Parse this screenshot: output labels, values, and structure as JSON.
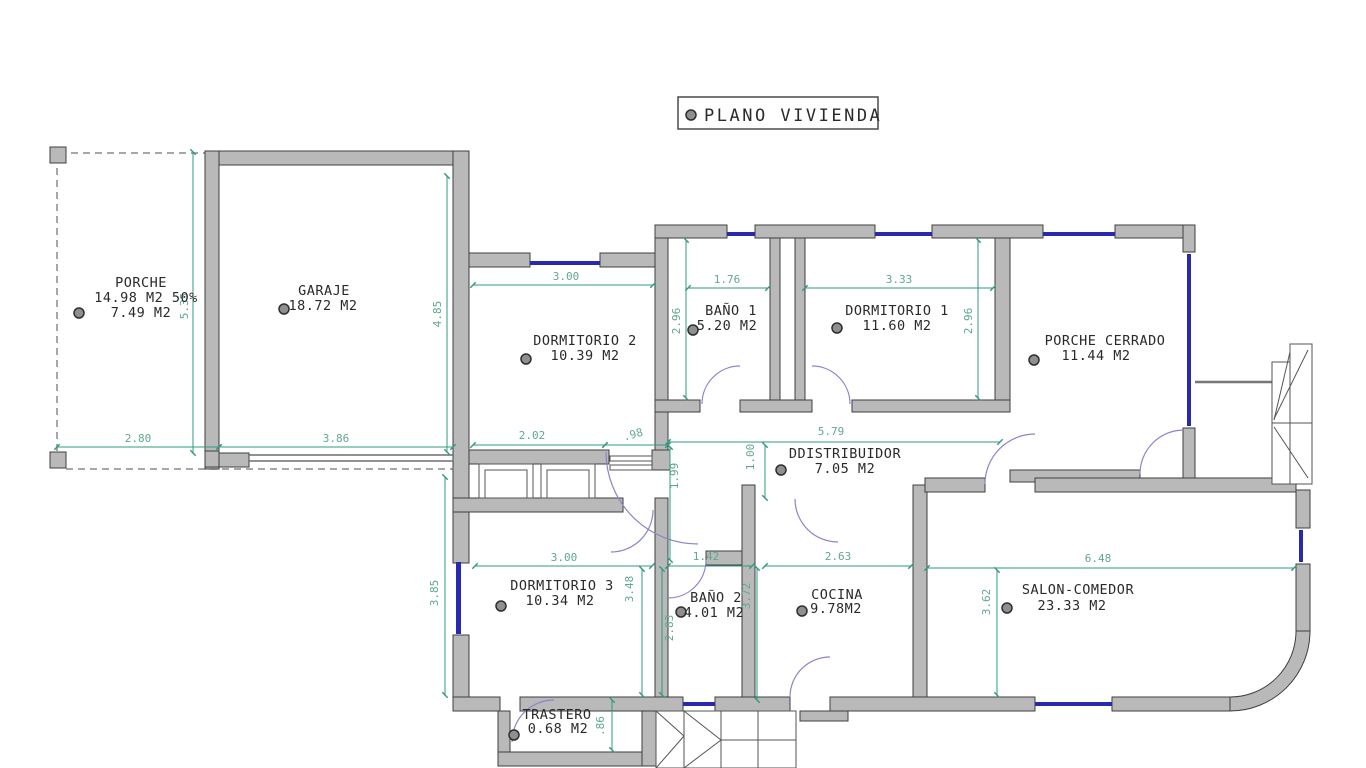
{
  "title": "PLANO VIVIENDA",
  "rooms": {
    "porche": {
      "name": "PORCHE",
      "line2": "14.98 M2 50%",
      "line3": "7.49 M2"
    },
    "garaje": {
      "name": "GARAJE",
      "area": "18.72 M2"
    },
    "dormitorio2": {
      "name": "DORMITORIO 2",
      "area": "10.39 M2"
    },
    "bano1": {
      "name": "BAÑO 1",
      "area": "5.20 M2"
    },
    "dormitorio1": {
      "name": "DORMITORIO 1",
      "area": "11.60 M2"
    },
    "porche_cerrado": {
      "name": "PORCHE CERRADO",
      "area": "11.44 M2"
    },
    "distribuidor": {
      "name": "DDISTRIBUIDOR",
      "area": "7.05 M2"
    },
    "dormitorio3": {
      "name": "DORMITORIO 3",
      "area": "10.34 M2"
    },
    "bano2": {
      "name": "BAÑO 2",
      "area": "4.01 M2"
    },
    "cocina": {
      "name": "COCINA",
      "area": "9.78M2"
    },
    "salon": {
      "name": "SALON-COMEDOR",
      "area": "23.33 M2"
    },
    "trastero": {
      "name": "TRASTERO",
      "area": "0.68 M2"
    }
  },
  "dimensions": {
    "porche_width": "2.80",
    "garaje_width": "3.86",
    "hall_width": "2.02",
    "entrance_door": ".98",
    "distribuidor_width": "5.79",
    "dorm2_width": "3.00",
    "bano1_width": "1.76",
    "dorm1_width": "3.33",
    "dorm3_width": "3.00",
    "bano2_width": "1.42",
    "cocina_width": "2.63",
    "salon_width": "6.48",
    "porche_height": "5.35",
    "garaje_height": "4.85",
    "bano1_height": "2.96",
    "dorm1_height": "2.96",
    "hall_height": "1.99",
    "distribuidor_pass": "1.00",
    "dorm3_height": "3.48",
    "dorm3_left_height": "3.85",
    "bano2_height": "2.83",
    "cocina_height": "3.72",
    "salon_height": "3.62",
    "trastero_height": ".86"
  },
  "colors": {
    "wall": "#b9b9b9",
    "wall_stroke": "#3f3f3f",
    "dimension": "#2f9b80",
    "dimension_text": "#5fa88f",
    "window": "#2929ae",
    "door_arc": "#8886c9",
    "text": "#2a2a2a",
    "marker": "#8f8f8f"
  }
}
